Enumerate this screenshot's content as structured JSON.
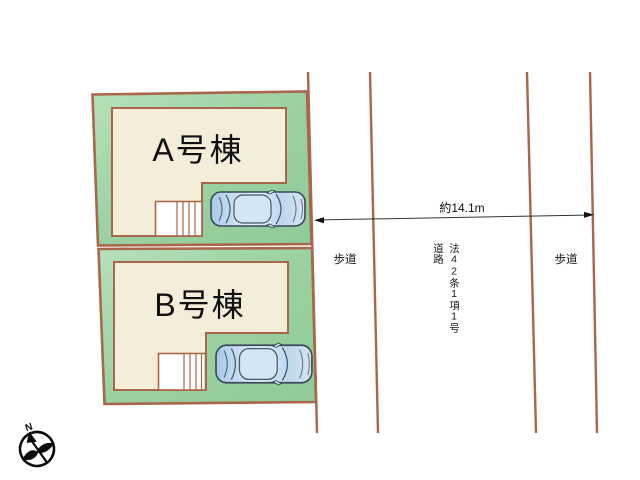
{
  "plots": {
    "a": {
      "label": "A号棟"
    },
    "b": {
      "label": "B号棟"
    }
  },
  "dimension": {
    "label": "約14.1m"
  },
  "road": {
    "name": "法42条1項1号道路",
    "sidewalk_left": "歩道",
    "sidewalk_right": "歩道"
  },
  "compass": {
    "letter": "N"
  },
  "colors": {
    "plot_green": "#9dd2a3",
    "boundary_brown": "#a9664a",
    "building_cream": "#f4edda",
    "stairs_white": "#ffffff",
    "car_blue": "#c7dcf0",
    "car_outline": "#3b4a57",
    "dimension_line": "#333333",
    "text": "#111111"
  }
}
